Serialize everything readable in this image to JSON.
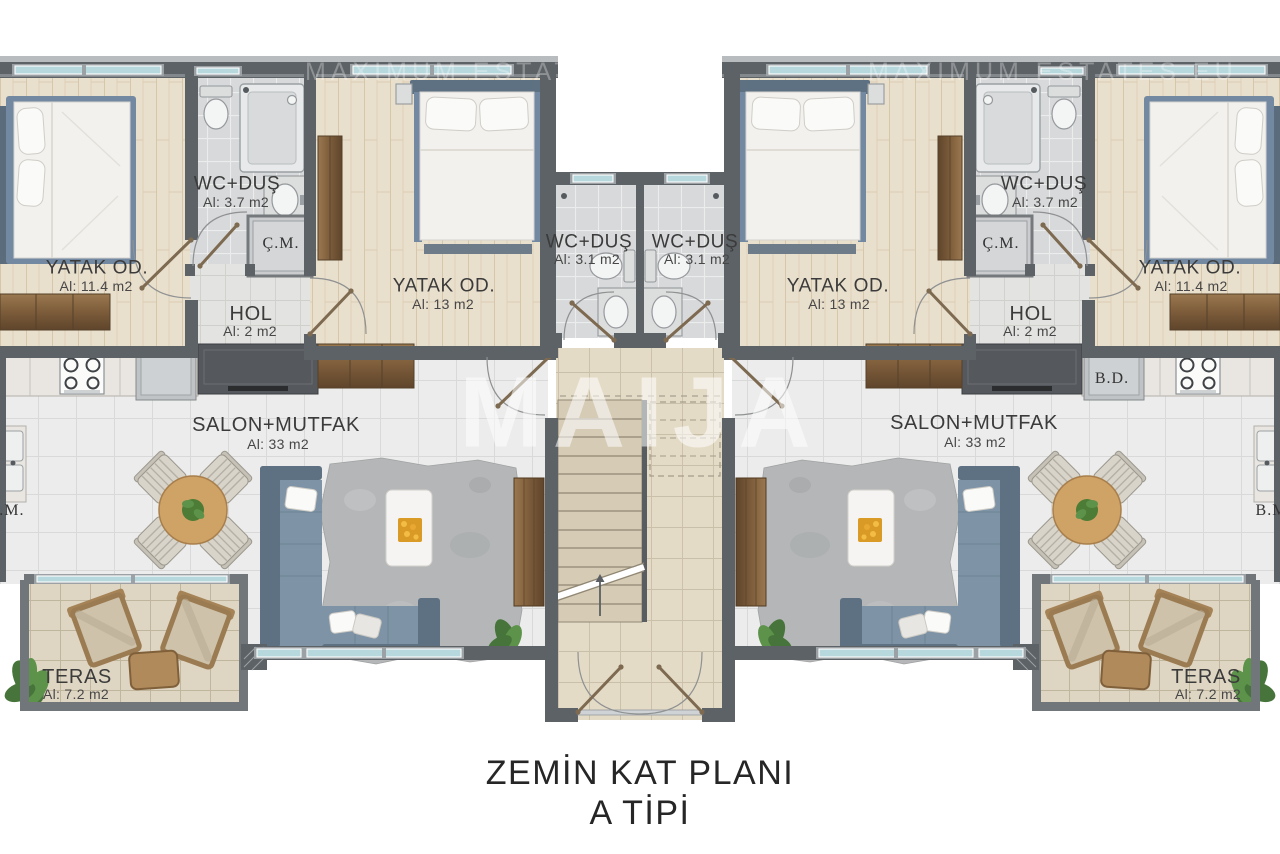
{
  "title": {
    "line1": "ZEMİN KAT PLANI",
    "line2": "A TİPİ"
  },
  "watermarks": {
    "center": "MAIJA",
    "top": "MAXIMUM ESTATES EU"
  },
  "rooms": {
    "bedroom_small": {
      "name": "YATAK OD.",
      "area": "Al: 11.4 m2"
    },
    "bedroom_large": {
      "name": "YATAK OD.",
      "area": "Al: 13 m2"
    },
    "bath_large": {
      "name": "WC+DUŞ",
      "area": "Al: 3.7 m2"
    },
    "bath_small": {
      "name": "WC+DUŞ",
      "area": "Al: 3.1 m2"
    },
    "hall": {
      "name": "HOL",
      "area": "Al: 2 m2"
    },
    "living": {
      "name": "SALON+MUTFAK",
      "area": "Al: 33 m2"
    },
    "terrace": {
      "name": "TERAS",
      "area": "Al: 7.2 m2"
    },
    "closet": "Ç.M.",
    "appliance_bd": "B.D.",
    "appliance_bm": "B.M."
  },
  "colors": {
    "wall": "#5d6266",
    "glass": "#b7d8dd",
    "bedframe": "#7289a1",
    "sofa": "#7e94a6",
    "sofadark": "#5e7183",
    "door": "#7d6a50",
    "label": "#3b3b3b"
  }
}
